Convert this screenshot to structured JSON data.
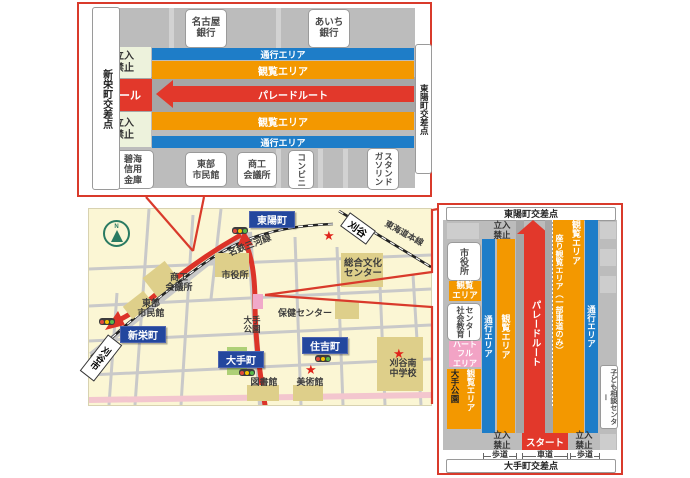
{
  "colors": {
    "accent_red": "#d93a2b",
    "band_blue": "#1e7dc8",
    "band_orange": "#f39800",
    "route_red": "#e2382b",
    "label_navy": "#23479e",
    "heartful_pink": "#f2a3c5",
    "no_entry_green": "#edf2dc",
    "map_cream": "#fbf6d4",
    "building_tan": "#decf8a"
  },
  "top_diagram": {
    "left_intersection": "新栄町交差点",
    "right_intersection": "東陽町交差点",
    "bank_nagoya": "名古屋\n銀行",
    "bank_aichi": "あいち\n銀行",
    "no_entry": "立入\n禁止",
    "goal": "ゴール",
    "passage_area": "通行エリア",
    "viewing_area": "観覧エリア",
    "parade_route": "パレードルート",
    "sidewalk": "歩道",
    "roadway": "車道",
    "shinkin_bank": "碧海\n信用\n金庫",
    "civic_hall": "東部\n市民館",
    "chamber": "商工\n会議所",
    "convenience": "コンビニ",
    "gas_station": "ガソリン\nスタンド"
  },
  "map": {
    "toyocho": "東陽町",
    "shinsakae": "新栄町",
    "otemachi": "大手町",
    "sumiyoshicho": "住吉町",
    "kariya_station": "刈谷",
    "kariya_city": "刈谷市",
    "meitetsu_line": "名鉄三河線",
    "tokaido_line": "東海道本線",
    "chamber": "商工\n会議所",
    "civic_hall": "東部\n市民館",
    "city_hall": "市役所",
    "culture_center": "総合文化\nセンター",
    "health_center": "保健センター",
    "ote_park": "大手\n公園",
    "library": "図書館",
    "museum": "美術館",
    "school": "刈谷南\n中学校",
    "compass_n": "N",
    "star": "★"
  },
  "right_diagram": {
    "top_intersection": "東陽町交差点",
    "bottom_intersection": "大手町交差点",
    "no_entry": "立入\n禁止",
    "start": "スタート",
    "passage_area": "通行エリア",
    "viewing_area": "観覧エリア",
    "parade_route": "パレードルート",
    "seated_viewing": "座り観覧エリア（一部車道のみ）",
    "city_hall": "市役所",
    "viewing_label": "観覧\nエリア",
    "social_education": "社会教育\nセンター",
    "heartful": "ハート\nフル\nエリア",
    "ote_park": "大手公園",
    "child_center": "子ども相談センター",
    "sidewalk": "歩道",
    "roadway": "車道"
  }
}
